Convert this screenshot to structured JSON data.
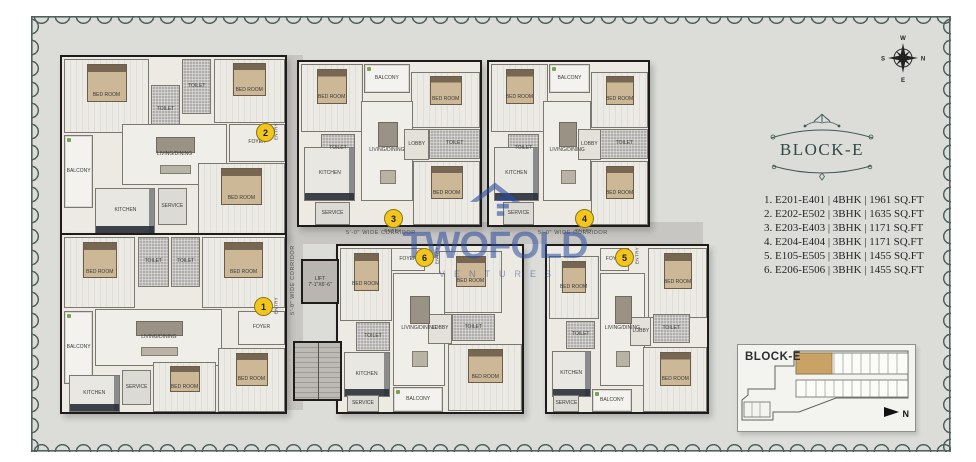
{
  "colors": {
    "border": "#4e615f",
    "inner_bg": "#dcddd9",
    "marker": "#f3c61e",
    "watermark_blue": "#2b4b9d",
    "keyplan_highlight": "#c9a365"
  },
  "watermark": {
    "brand": "TWOFOLD",
    "sub": "VENTURES"
  },
  "compass": {
    "top": "W",
    "right": "N",
    "left": "S",
    "bottom": "E"
  },
  "panel": {
    "title": "BLOCK-E",
    "units": [
      "1. E201-E401 | 4BHK | 1961 SQ.FT",
      "2. E202-E502 | 3BHK | 1635 SQ.FT",
      "3. E203-E403 | 3BHK | 1171 SQ.FT",
      "4. E204-E404 | 3BHK | 1171 SQ.FT",
      "5. E105-E505 | 3BHK | 1455 SQ.FT",
      "6. E206-E506 | 3BHK | 1455 SQ.FT"
    ]
  },
  "keyplan": {
    "title": "BLOCK-E",
    "north": "N"
  },
  "plan": {
    "corridor_label": "5'-0\" WIDE CORRIDOR",
    "entry_label": "ENTRY",
    "lift_label": "LIFT",
    "lift_dim": "7'-1\"X6'-6\"",
    "markers": [
      "1",
      "2",
      "3",
      "4",
      "5",
      "6"
    ],
    "labels": {
      "bedroom": "BED ROOM",
      "living": "LIVING/DINING",
      "kitchen": "KITCHEN",
      "toilet": "TOILET",
      "service": "SERVICE",
      "balcony": "BALCONY",
      "foyer": "FOYER",
      "lobby": "LOBBY"
    }
  }
}
